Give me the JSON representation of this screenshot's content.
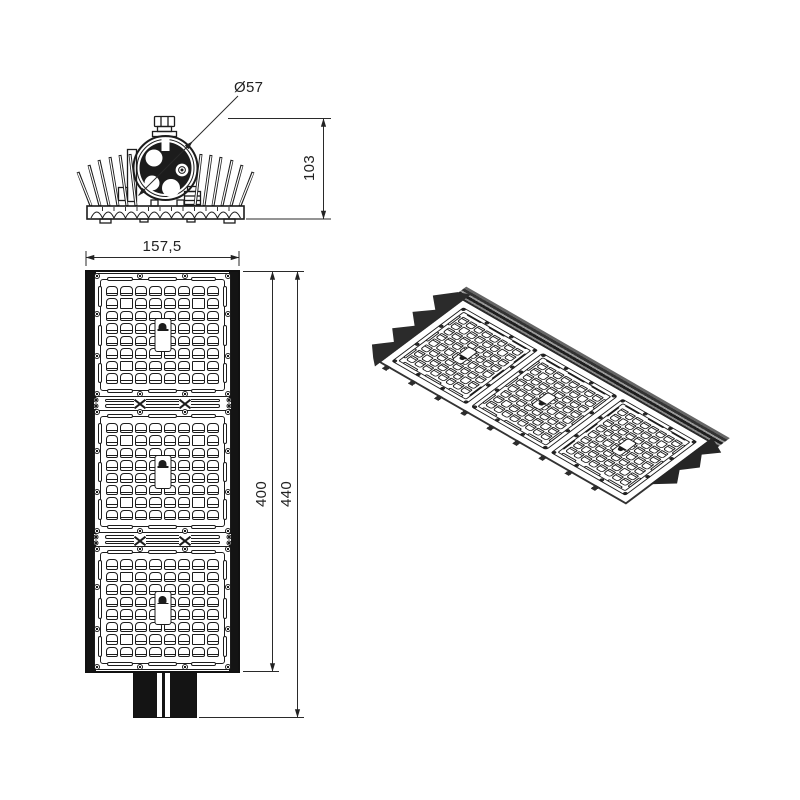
{
  "drawing": {
    "title": "street-light-luminaire-technical-drawing",
    "background": "#ffffff",
    "ink": "#1c1c1c",
    "dimensions": {
      "clamp_diameter": "Ø57",
      "front_height": "103",
      "plan_width": "157,5",
      "body_length": "400",
      "overall_length": "440"
    },
    "panel": {
      "module_count": 3,
      "grid_rows": 8,
      "grid_cols": 8,
      "plain_cells": [
        [
          1,
          1
        ],
        [
          1,
          6
        ],
        [
          6,
          1
        ],
        [
          6,
          6
        ]
      ],
      "center_label_icon": "hot-surface-warning-icon",
      "screw_positions": [
        [
          1.5,
          1.5
        ],
        [
          33,
          1.5
        ],
        [
          67,
          1.5
        ],
        [
          98.5,
          1.5
        ],
        [
          1.5,
          33
        ],
        [
          1.5,
          67
        ],
        [
          98.5,
          33
        ],
        [
          98.5,
          67
        ],
        [
          1.5,
          98.5
        ],
        [
          33,
          98.5
        ],
        [
          67,
          98.5
        ],
        [
          98.5,
          98.5
        ]
      ],
      "strip_screw_positions": [
        [
          1.8,
          25
        ],
        [
          1.8,
          75
        ],
        [
          98.2,
          25
        ],
        [
          98.2,
          75
        ]
      ]
    }
  }
}
